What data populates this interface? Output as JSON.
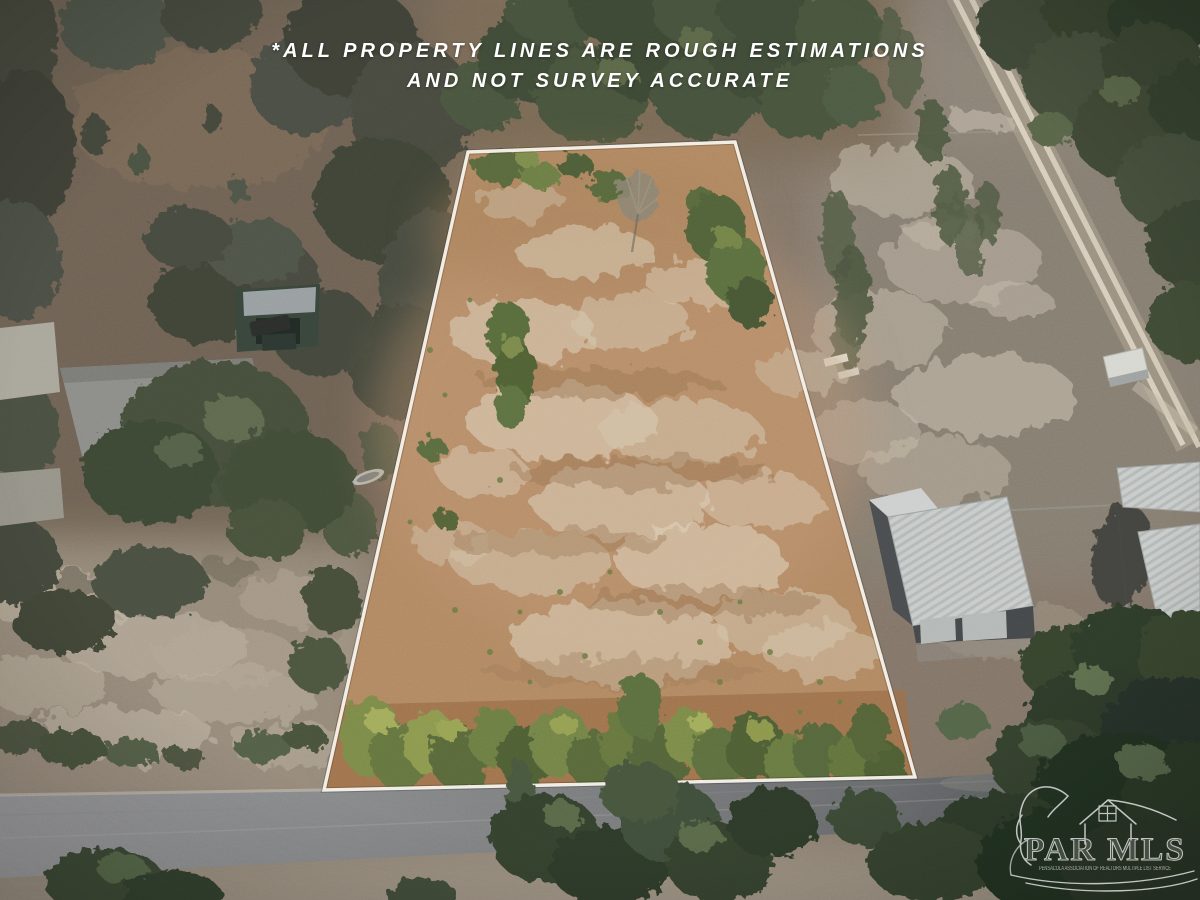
{
  "photo": {
    "kind": "aerial-drone-property-photo",
    "disclaimer_line1": "*ALL PROPERTY LINES ARE ROUGH ESTIMATIONS",
    "disclaimer_line2": "AND NOT SURVEY ACCURATE",
    "watermark": {
      "title": "PAR MLS",
      "subtitle": "PENSACOLA ASSOCIATION OF REALTORS MULTIPLE LIST SERVICE"
    },
    "scene": {
      "label": "Cleared vacant land parcel outlined in white; paved road below, wooded homesites left, metal outbuildings right, dirt two-track road upper right",
      "boundary_color": "#f6f3ea",
      "parcel_dirt_color": "#b28a64",
      "sand_patch_color": "#d9ccb4",
      "road_color": "#7a7c7e",
      "tree_dark_color": "#2e3a2a",
      "tree_light_color": "#6e7f44",
      "metal_roof_color": "#c8ccca",
      "litter_color": "#9c6f4a"
    }
  }
}
